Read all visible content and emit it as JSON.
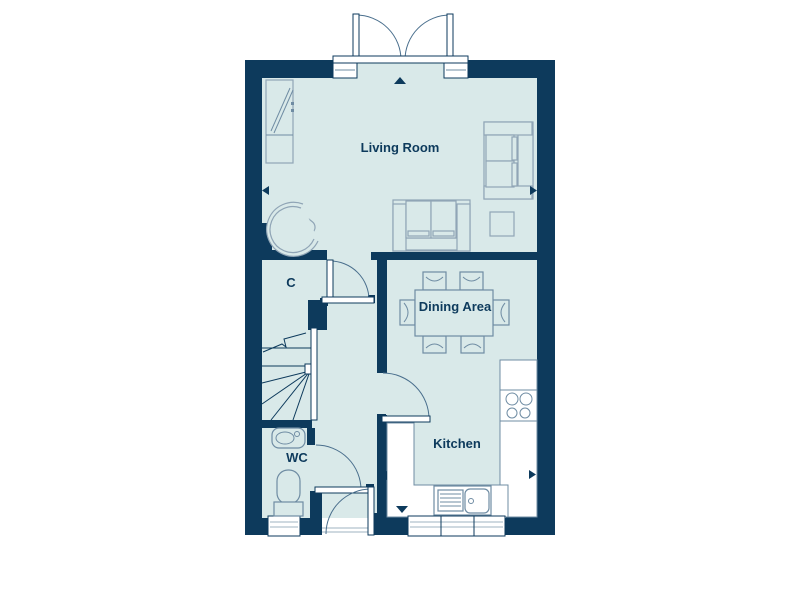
{
  "plan": {
    "rooms": {
      "living_room": {
        "label": "Living Room"
      },
      "dining_area": {
        "label": "Dining Area"
      },
      "kitchen": {
        "label": "Kitchen"
      },
      "closet": {
        "label": "C"
      },
      "wc": {
        "label": "WC"
      }
    },
    "colors": {
      "wall_navy": "#0d3a5c",
      "floor_teal": "#d9e9e9",
      "fixture_line": "#6f8ca3",
      "furniture_line": "#90a5b6",
      "door_arc": "#4a6f8d",
      "counter_white": "#ffffff"
    },
    "features": {
      "french_doors": "double doors top, opening outward",
      "dimension_markers": [
        "up",
        "down",
        "left-living",
        "right-living",
        "left-kitchen",
        "right-kitchen"
      ]
    }
  }
}
